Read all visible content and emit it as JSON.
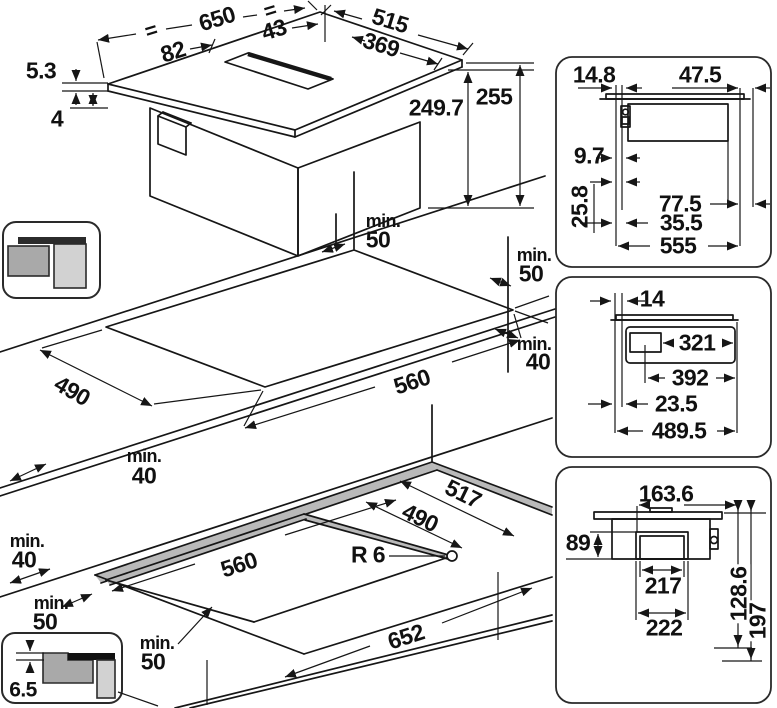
{
  "shared": {
    "min_prefix": "min."
  },
  "iso_view": {
    "equal_left": "=",
    "equal_right": "=",
    "width": "650",
    "vent_offset": "43",
    "depth": "515",
    "vent_depth": "369",
    "left_inset": "82",
    "glass_thickness": "5.3",
    "glass_overhang": "4",
    "body_height": "249.7",
    "total_height": "255"
  },
  "surface_cutout": {
    "width": "560",
    "depth": "490",
    "back_clearance": "50",
    "back_right_clearance": "50",
    "right_clearance": "40",
    "left_clearance": "40"
  },
  "flush_cutout": {
    "width": "560",
    "depth": "490",
    "recess_width": "652",
    "recess_depth": "517",
    "corner_radius": "R 6",
    "back_clearance": "40",
    "mid_clearance": "50",
    "front_clearance": "50",
    "rebate_depth": "6.5"
  },
  "side_section": {
    "glass_front_overhang": "14.8",
    "glass_back_overhang": "47.5",
    "front_gap": "9.7",
    "front_offset": "25.8",
    "back_offset": "77.5",
    "side_offset": "35.5",
    "body_width": "555"
  },
  "front_section": {
    "glass_overhang": "14",
    "duct_offset": "321",
    "duct_center_offset": "392",
    "side_gap": "23.5",
    "body_depth": "489.5"
  },
  "bottom_view": {
    "outlet_offset": "163.6",
    "outlet_height": "89",
    "outlet_width_inner": "217",
    "outlet_width_outer": "222",
    "outlet_depth": "128.6",
    "total_depth": "197"
  }
}
